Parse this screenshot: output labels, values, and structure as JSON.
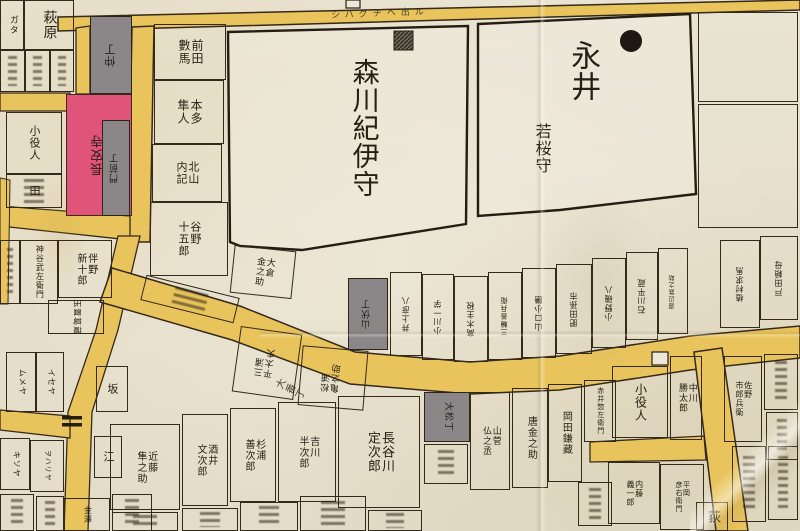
{
  "palette": {
    "paper": "#e8e2d1",
    "road_yellow": "#e9c45c",
    "road_edge": "#34291a",
    "ink": "#271f14",
    "temple_pink": "#e0547a",
    "townhouse_gray": "#8b8789",
    "big_plot_fill": "#f0ebdd"
  },
  "big": {
    "morikawa": {
      "label": "森川紀伊守",
      "marker": "hatched-square"
    },
    "nagai": {
      "label_top": "永井",
      "label_bottom": "若桜守",
      "marker": "black-circle"
    }
  },
  "road_labels": {
    "top_road_note": "シバグチヘ出ル",
    "bend_street": "大番丁"
  },
  "plots": [
    {
      "n": "plot-kata",
      "x": 0,
      "y": 0,
      "w": 24,
      "h": 50,
      "t": "ガタ",
      "fs": 9
    },
    {
      "n": "plot-hagiwara",
      "x": 24,
      "y": 0,
      "w": 50,
      "h": 50,
      "t": "萩原",
      "fs": 14
    },
    {
      "n": "plot-small-1",
      "x": 0,
      "y": 50,
      "w": 25,
      "h": 42,
      "t": "",
      "scr": 1
    },
    {
      "n": "plot-small-2",
      "x": 25,
      "y": 50,
      "w": 25,
      "h": 42,
      "t": "",
      "scr": 1
    },
    {
      "n": "plot-small-3",
      "x": 50,
      "y": 50,
      "w": 24,
      "h": 42,
      "t": "",
      "scr": 1
    },
    {
      "n": "plot-koyakunin-west",
      "x": 6,
      "y": 112,
      "w": 56,
      "h": 62,
      "t": "小役人",
      "fs": 11
    },
    {
      "n": "plot-ta",
      "x": 6,
      "y": 174,
      "w": 56,
      "h": 34,
      "t": "田",
      "fs": 11,
      "scr": 1
    },
    {
      "n": "plot-kuji",
      "x": 0,
      "y": 240,
      "w": 20,
      "h": 64,
      "t": "",
      "scr": 1
    },
    {
      "n": "plot-kamiya",
      "x": 20,
      "y": 240,
      "w": 38,
      "h": 64,
      "t": "神谷武左衛門",
      "fs": 8
    },
    {
      "n": "plot-banno",
      "x": 58,
      "y": 240,
      "w": 54,
      "h": 58,
      "t": "伴野\n新十郎",
      "fs": 10
    },
    {
      "n": "plot-tamaki",
      "x": 48,
      "y": 300,
      "w": 56,
      "h": 34,
      "t": "玉置葛蔵",
      "fs": 8,
      "r90": 1
    },
    {
      "n": "plot-mumeya",
      "x": 6,
      "y": 352,
      "w": 30,
      "h": 60,
      "t": "ムメヤ",
      "fs": 8,
      "r90": 1
    },
    {
      "n": "plot-iseya",
      "x": 36,
      "y": 352,
      "w": 28,
      "h": 60,
      "t": "イセヤ",
      "fs": 8,
      "r90": 1
    },
    {
      "n": "plot-saka",
      "x": 96,
      "y": 366,
      "w": 32,
      "h": 46,
      "t": "坂",
      "fs": 11
    },
    {
      "n": "plot-e",
      "x": 94,
      "y": 436,
      "w": 28,
      "h": 42,
      "t": "江",
      "fs": 11
    },
    {
      "n": "plot-owariya",
      "x": 30,
      "y": 440,
      "w": 34,
      "h": 52,
      "t": "ヲハリヤ",
      "fs": 7,
      "r90": 1
    },
    {
      "n": "plot-kisoya",
      "x": 0,
      "y": 438,
      "w": 30,
      "h": 52,
      "t": "キソヤ",
      "fs": 8,
      "r90": 1
    },
    {
      "n": "plot-corner-1",
      "x": 0,
      "y": 494,
      "w": 34,
      "h": 37,
      "t": "",
      "scr": 1
    },
    {
      "n": "plot-corner-2",
      "x": 36,
      "y": 496,
      "w": 28,
      "h": 35,
      "t": "",
      "scr": 1
    },
    {
      "n": "plot-kanazawa",
      "x": 64,
      "y": 498,
      "w": 46,
      "h": 33,
      "t": "金澤",
      "fs": 8
    },
    {
      "n": "plot-corner-3",
      "x": 112,
      "y": 494,
      "w": 40,
      "h": 37,
      "t": "",
      "scr": 1
    },
    {
      "n": "plot-nakacho",
      "x": 90,
      "y": 16,
      "w": 42,
      "h": 78,
      "t": "仲丁",
      "fs": 11,
      "flip": 1,
      "fill": "gray"
    },
    {
      "n": "plot-choanji-temple",
      "x": 66,
      "y": 94,
      "w": 66,
      "h": 122,
      "t": "長安寺",
      "fs": 13,
      "flip": 1,
      "fill": "pink"
    },
    {
      "n": "plot-monzencho",
      "x": 102,
      "y": 120,
      "w": 28,
      "h": 96,
      "t": "門前丁",
      "fs": 9,
      "flip": 1,
      "fill": "gray"
    },
    {
      "n": "plot-maeda-kazuma",
      "x": 154,
      "y": 24,
      "w": 72,
      "h": 56,
      "t": "前田\n數馬",
      "fs": 12
    },
    {
      "n": "plot-honda-hayato",
      "x": 154,
      "y": 80,
      "w": 70,
      "h": 64,
      "t": "本多\n隼人",
      "fs": 12
    },
    {
      "n": "plot-kitayama-naiki",
      "x": 152,
      "y": 144,
      "w": 70,
      "h": 58,
      "t": "北山\n内記",
      "fs": 11
    },
    {
      "n": "plot-yano-jugoro",
      "x": 150,
      "y": 202,
      "w": 78,
      "h": 74,
      "t": "谷野\n十五郎",
      "fs": 11
    },
    {
      "n": "plot-okura-kinnosuke",
      "x": 232,
      "y": 248,
      "w": 62,
      "h": 48,
      "t": "大倉\n金之助",
      "fs": 9,
      "rot": 6
    },
    {
      "n": "plot-strip-note",
      "x": 142,
      "y": 286,
      "w": 96,
      "h": 26,
      "t": "",
      "scr": 1,
      "rot": 14
    },
    {
      "n": "plot-band-s1",
      "x": 236,
      "y": 330,
      "w": 62,
      "h": 66,
      "t": "三浦\n平太夫",
      "fs": 9,
      "flip": 1,
      "rot": 8
    },
    {
      "n": "plot-band-s2",
      "x": 300,
      "y": 348,
      "w": 66,
      "h": 60,
      "t": "松浦\n亀之助",
      "fs": 9,
      "flip": 1,
      "rot": 5
    },
    {
      "n": "plot-yamabushicho",
      "x": 348,
      "y": 278,
      "w": 40,
      "h": 72,
      "t": "山伏丁",
      "fs": 9,
      "flip": 1,
      "fill": "gray"
    },
    {
      "n": "plot-band-n1",
      "x": 390,
      "y": 272,
      "w": 32,
      "h": 84,
      "t": "井上彦八",
      "fs": 8,
      "flip": 1
    },
    {
      "n": "plot-band-n2",
      "x": 422,
      "y": 274,
      "w": 32,
      "h": 86,
      "t": "小川一学",
      "fs": 8,
      "flip": 1
    },
    {
      "n": "plot-band-n3",
      "x": 454,
      "y": 276,
      "w": 34,
      "h": 86,
      "t": "高木主税",
      "fs": 8,
      "flip": 1
    },
    {
      "n": "plot-band-n4",
      "x": 488,
      "y": 272,
      "w": 34,
      "h": 88,
      "t": "三輪善兵衛",
      "fs": 7,
      "flip": 1
    },
    {
      "n": "plot-band-n5",
      "x": 522,
      "y": 268,
      "w": 34,
      "h": 90,
      "t": "山口小膳",
      "fs": 8,
      "flip": 1
    },
    {
      "n": "plot-band-n6",
      "x": 556,
      "y": 264,
      "w": 36,
      "h": 90,
      "t": "肥田孫市",
      "fs": 8,
      "flip": 1
    },
    {
      "n": "plot-band-n7",
      "x": 592,
      "y": 258,
      "w": 34,
      "h": 90,
      "t": "小野磯八",
      "fs": 8,
      "flip": 1
    },
    {
      "n": "plot-band-n8",
      "x": 626,
      "y": 252,
      "w": 32,
      "h": 88,
      "t": "石川平蔵",
      "fs": 8,
      "flip": 1
    },
    {
      "n": "plot-band-n9",
      "x": 658,
      "y": 248,
      "w": 30,
      "h": 86,
      "t": "渡辺鉄之助",
      "fs": 6,
      "flip": 1
    },
    {
      "n": "plot-band-n10",
      "x": 720,
      "y": 240,
      "w": 40,
      "h": 88,
      "t": "植村求馬",
      "fs": 8,
      "flip": 1
    },
    {
      "n": "plot-band-n11",
      "x": 760,
      "y": 236,
      "w": 38,
      "h": 84,
      "t": "戸田頼母",
      "fs": 8,
      "flip": 1
    },
    {
      "n": "plot-kondo",
      "x": 110,
      "y": 424,
      "w": 70,
      "h": 86,
      "t": "近藤\n隼之助",
      "fs": 10
    },
    {
      "n": "plot-sakai",
      "x": 182,
      "y": 414,
      "w": 46,
      "h": 92,
      "t": "酒井\n文次郎",
      "fs": 10
    },
    {
      "n": "plot-sugiura",
      "x": 230,
      "y": 408,
      "w": 46,
      "h": 94,
      "t": "杉浦\n善次郎",
      "fs": 10
    },
    {
      "n": "plot-yoshikawa",
      "x": 278,
      "y": 402,
      "w": 58,
      "h": 100,
      "t": "吉川\n半次郎",
      "fs": 10
    },
    {
      "n": "plot-hasegawa",
      "x": 338,
      "y": 396,
      "w": 82,
      "h": 112,
      "t": "長谷川\n定次郎",
      "fs": 13
    },
    {
      "n": "plot-omatsucho",
      "x": 424,
      "y": 392,
      "w": 46,
      "h": 50,
      "t": "大松丁",
      "fs": 9,
      "r90": 1,
      "fill": "gray"
    },
    {
      "n": "plot-yamasuga",
      "x": 470,
      "y": 392,
      "w": 40,
      "h": 98,
      "t": "山菅\n仏之丞",
      "fs": 9
    },
    {
      "n": "plot-karakane",
      "x": 512,
      "y": 388,
      "w": 36,
      "h": 100,
      "t": "唐金之助",
      "fs": 10
    },
    {
      "n": "plot-okada-kamazo",
      "x": 548,
      "y": 384,
      "w": 34,
      "h": 98,
      "t": "岡田鎌藏",
      "fs": 10
    },
    {
      "n": "plot-akai",
      "x": 584,
      "y": 380,
      "w": 32,
      "h": 62,
      "t": "赤井惣左衛門",
      "fs": 7
    },
    {
      "n": "plot-row2-1",
      "x": 112,
      "y": 512,
      "w": 66,
      "h": 19,
      "t": "",
      "scr": 1
    },
    {
      "n": "plot-row2-2",
      "x": 182,
      "y": 508,
      "w": 56,
      "h": 23,
      "t": "",
      "scr": 1
    },
    {
      "n": "plot-row2-3",
      "x": 240,
      "y": 502,
      "w": 58,
      "h": 29,
      "t": "",
      "scr": 1
    },
    {
      "n": "plot-row2-4",
      "x": 300,
      "y": 496,
      "w": 66,
      "h": 35,
      "t": "",
      "scr": 1
    },
    {
      "n": "plot-row2-5",
      "x": 368,
      "y": 510,
      "w": 54,
      "h": 21,
      "t": "",
      "scr": 1
    },
    {
      "n": "plot-row2-6",
      "x": 424,
      "y": 444,
      "w": 44,
      "h": 40,
      "t": "",
      "scr": 1
    },
    {
      "n": "plot-hiki",
      "x": 578,
      "y": 482,
      "w": 34,
      "h": 44,
      "t": "",
      "scr": 1
    },
    {
      "n": "plot-koyakunin-east",
      "x": 612,
      "y": 366,
      "w": 56,
      "h": 72,
      "t": "小役人",
      "fs": 12
    },
    {
      "n": "plot-nakagawa-katsutaro",
      "x": 670,
      "y": 356,
      "w": 32,
      "h": 84,
      "t": "中川\n勝太郎",
      "fs": 9
    },
    {
      "n": "plot-naito",
      "x": 608,
      "y": 462,
      "w": 52,
      "h": 62,
      "t": "内藤\n義一郎",
      "fs": 8
    },
    {
      "n": "plot-hiraoka",
      "x": 660,
      "y": 464,
      "w": 44,
      "h": 66,
      "t": "平岡\n彦右衛門",
      "fs": 7
    },
    {
      "n": "plot-ogi",
      "x": 696,
      "y": 502,
      "w": 32,
      "h": 29,
      "t": "荻",
      "fs": 13
    },
    {
      "n": "plot-sano",
      "x": 724,
      "y": 356,
      "w": 38,
      "h": 86,
      "t": "佐野\n市郎兵衛",
      "fs": 8
    },
    {
      "n": "plot-east-1",
      "x": 764,
      "y": 354,
      "w": 34,
      "h": 56,
      "t": "",
      "scr": 1
    },
    {
      "n": "plot-east-2",
      "x": 766,
      "y": 412,
      "w": 32,
      "h": 48,
      "t": "",
      "scr": 1
    },
    {
      "n": "plot-east-3",
      "x": 732,
      "y": 446,
      "w": 34,
      "h": 76,
      "t": "",
      "scr": 1
    },
    {
      "n": "plot-east-4",
      "x": 768,
      "y": 446,
      "w": 30,
      "h": 74,
      "t": "",
      "scr": 1
    },
    {
      "n": "plot-ne-empty-1",
      "x": 698,
      "y": 12,
      "w": 100,
      "h": 90,
      "t": ""
    },
    {
      "n": "plot-ne-empty-2",
      "x": 698,
      "y": 104,
      "w": 100,
      "h": 124,
      "t": ""
    },
    {
      "n": "label-morikawa",
      "x": 330,
      "y": 38,
      "w": 66,
      "h": 180,
      "t": "森川紀伊守",
      "fs": 27,
      "nb": 1
    },
    {
      "n": "label-nagai",
      "x": 556,
      "y": 30,
      "w": 52,
      "h": 82,
      "t": "永井",
      "fs": 30,
      "nb": 1
    },
    {
      "n": "label-wakasanokami",
      "x": 522,
      "y": 98,
      "w": 40,
      "h": 100,
      "t": "若桜守",
      "fs": 16,
      "nb": 1
    },
    {
      "n": "label-road-note",
      "x": 300,
      "y": 6,
      "w": 160,
      "h": 18,
      "t": "シバグチヘ出ル",
      "fs": 9,
      "hm": 1,
      "ls": 5,
      "rot": -2,
      "nb": 1,
      "faint": 1
    },
    {
      "n": "label-obancho",
      "x": 278,
      "y": 368,
      "w": 22,
      "h": 46,
      "t": "大番丁",
      "fs": 10,
      "rot": -62,
      "nb": 1,
      "faint": 1
    }
  ]
}
